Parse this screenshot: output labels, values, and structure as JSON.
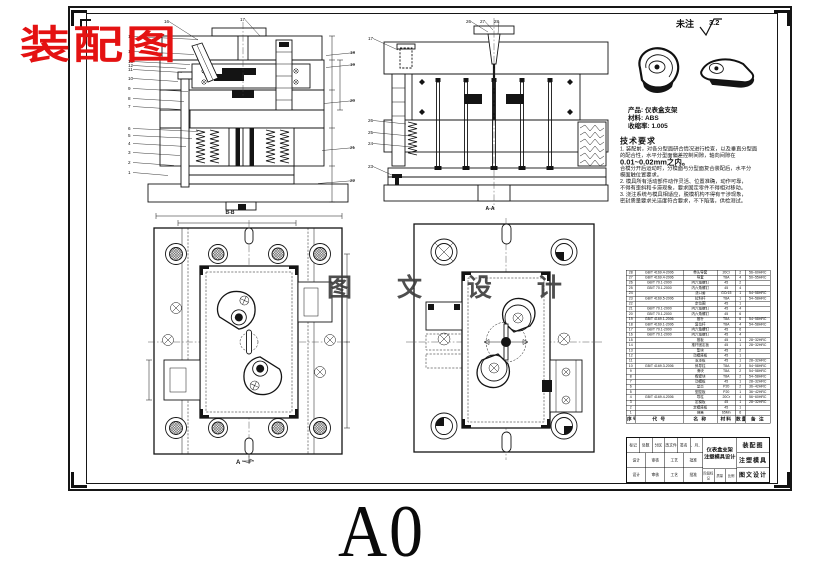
{
  "sheet": {
    "format_label": "A0"
  },
  "stamps": {
    "red_title": "装配图",
    "watermark": "图 文 设 计"
  },
  "surface_note": {
    "prefix": "未注",
    "value": "3.2"
  },
  "product_info": {
    "product_label": "产品:",
    "product_value": "仪表盒支架",
    "material_label": "材料:",
    "material_value": "ABS",
    "shrinkage_label": "收缩率:",
    "shrinkage_value": "1.005"
  },
  "tech_requirements": {
    "title": "技术要求",
    "lines": [
      "1. 装配前，对各分型面研合情况进行检查，以及垂直分型面",
      "的配合性，水平分型面偏差控制间隙，轴向间隙在",
      "0.01~0.02mm之内。",
      "合模分开后运动时，分模面与分型面复合装配后，水平分",
      "模面触位置要求。",
      "2. 模具所有活动部件动作灵活、位置准确，动作可靠，",
      "不得有歪斜和卡滞现象，要求固定零件不得相对移动。",
      "3. 浇注系统与模具相适应，脱模机构不得有干涉现象，",
      "密封质量要求光洁度符合要求，不下陷落，供检测试。"
    ]
  },
  "views": {
    "section_b": {
      "label": "B-B",
      "callouts_left": [
        "15",
        "14",
        "13",
        "12",
        "11",
        "10",
        "9",
        "8",
        "7",
        "6",
        "5",
        "4",
        "3",
        "2",
        "1"
      ],
      "callouts_top": [
        "16",
        "17"
      ],
      "callouts_right": [
        "18",
        "19",
        "20",
        "21",
        "22"
      ]
    },
    "section_a": {
      "label": "A-A",
      "callouts_top": [
        "26",
        "27",
        "28"
      ],
      "callouts_left": [
        "17",
        "26",
        "25",
        "24",
        "23"
      ]
    },
    "plan_left": {
      "section_arrow_label": "A"
    }
  },
  "bom": {
    "headers": [
      "序号",
      "代  号",
      "名  称",
      "材料",
      "数量",
      "备 注"
    ],
    "rows": [
      [
        "28",
        "GB/T 4169.4-2006",
        "带头导套",
        "20Cr",
        "2",
        "56~60HRC"
      ],
      [
        "27",
        "GB/T 4169.4-2006",
        "导套",
        "T8A",
        "4",
        "50~55HRC"
      ],
      [
        "26",
        "GB/T 70.1-2000",
        "内六角螺钉",
        "45",
        "2",
        ""
      ],
      [
        "25",
        "GB/T 70.1-2000",
        "内六角螺钉",
        "45",
        "4",
        ""
      ],
      [
        "24",
        "",
        "浇口套",
        "GCr15",
        "1",
        "54~58HRC"
      ],
      [
        "23",
        "GB/T 4169.5-2006",
        "拉料杆",
        "T8A",
        "1",
        "54~58HRC"
      ],
      [
        "22",
        "",
        "定位圈",
        "45",
        "1",
        ""
      ],
      [
        "21",
        "GB/T 70.1-2000",
        "内六角螺钉",
        "45",
        "4",
        ""
      ],
      [
        "20",
        "GB/T 70.1-2000",
        "内六角螺钉",
        "45",
        "6",
        ""
      ],
      [
        "19",
        "GB/T 4169.1-2006",
        "推杆",
        "T8A",
        "6",
        "54~58HRC"
      ],
      [
        "18",
        "GB/T 4169.1-2006",
        "复位杆",
        "T8A",
        "4",
        "54~58HRC"
      ],
      [
        "17",
        "GB/T 70.1-2000",
        "内六角螺钉",
        "45",
        "6",
        ""
      ],
      [
        "16",
        "GB/T 70.1-2000",
        "内六角螺钉",
        "45",
        "4",
        ""
      ],
      [
        "15",
        "",
        "推板",
        "45",
        "1",
        "28~32HRC"
      ],
      [
        "14",
        "",
        "推杆固定板",
        "45",
        "1",
        "28~32HRC"
      ],
      [
        "13",
        "",
        "垫块",
        "45",
        "2",
        ""
      ],
      [
        "12",
        "",
        "动模座板",
        "45",
        "1",
        ""
      ],
      [
        "11",
        "",
        "支承板",
        "45",
        "1",
        "28~32HRC"
      ],
      [
        "10",
        "GB/T 4169.3-2006",
        "斜导柱",
        "T8A",
        "2",
        "54~58HRC"
      ],
      [
        "9",
        "",
        "滑块",
        "T8A",
        "2",
        "54~58HRC"
      ],
      [
        "8",
        "",
        "楔紧块",
        "T8A",
        "2",
        "54~58HRC"
      ],
      [
        "7",
        "",
        "动模板",
        "45",
        "1",
        "28~32HRC"
      ],
      [
        "6",
        "",
        "型芯",
        "P20",
        "2",
        "36~42HRC"
      ],
      [
        "5",
        "",
        "型腔板",
        "P20",
        "1",
        "36~42HRC"
      ],
      [
        "4",
        "GB/T 4169.4-2006",
        "导柱",
        "20Cr",
        "4",
        "56~60HRC"
      ],
      [
        "3",
        "",
        "定模板",
        "45",
        "1",
        "28~32HRC"
      ],
      [
        "2",
        "",
        "定模座板",
        "45",
        "1",
        ""
      ],
      [
        "1",
        "",
        "弹簧",
        "65Mn",
        "6",
        ""
      ]
    ]
  },
  "title_block": {
    "project_line1": "仪表盒支架",
    "project_line2": "注塑模具设计",
    "drawing_name": "装配图",
    "org_line1": "注塑模具",
    "org_line2": "图文设计",
    "rev_cells": [
      "标记",
      "处数",
      "分区",
      "更改文件号",
      "签名",
      "年、月、日"
    ],
    "sign_cells": [
      "设计",
      "审核",
      "工艺",
      "批准"
    ],
    "misc_cells": [
      "阶段标记",
      "质量",
      "比例"
    ]
  }
}
